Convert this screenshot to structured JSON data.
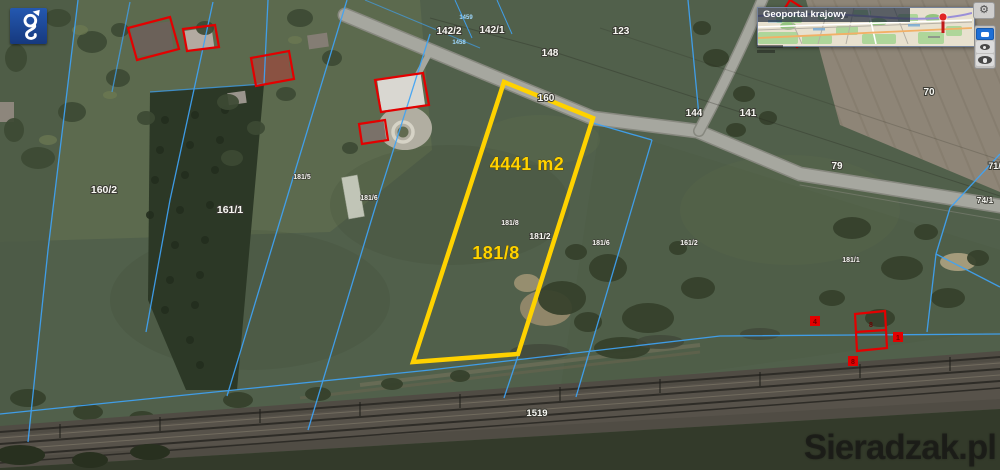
{
  "branding": {
    "watermark": "Sieradzak.pl"
  },
  "minimap": {
    "title": "Geoportal krajowy"
  },
  "controls": {
    "settings_glyph": "⚙"
  },
  "map": {
    "colors": {
      "highlight": "#FFD200",
      "boundary": "#3FA3F5",
      "building_outline": "#E30000"
    },
    "highlight": {
      "area_label": "4441 m2",
      "parcel_number": "181/8"
    },
    "parcel_labels": [
      "142/2",
      "142/1",
      "123",
      "148",
      "160",
      "144",
      "141",
      "70",
      "79",
      "71/1",
      "74/1",
      "160/2",
      "161/1",
      "181/5",
      "181/6",
      "181/8",
      "181/2",
      "181/6",
      "161/2",
      "181/1",
      "1519"
    ],
    "survey_point_labels": [
      "1459",
      "1458"
    ],
    "building_markers": [
      "4",
      "8",
      "8",
      "1"
    ]
  }
}
